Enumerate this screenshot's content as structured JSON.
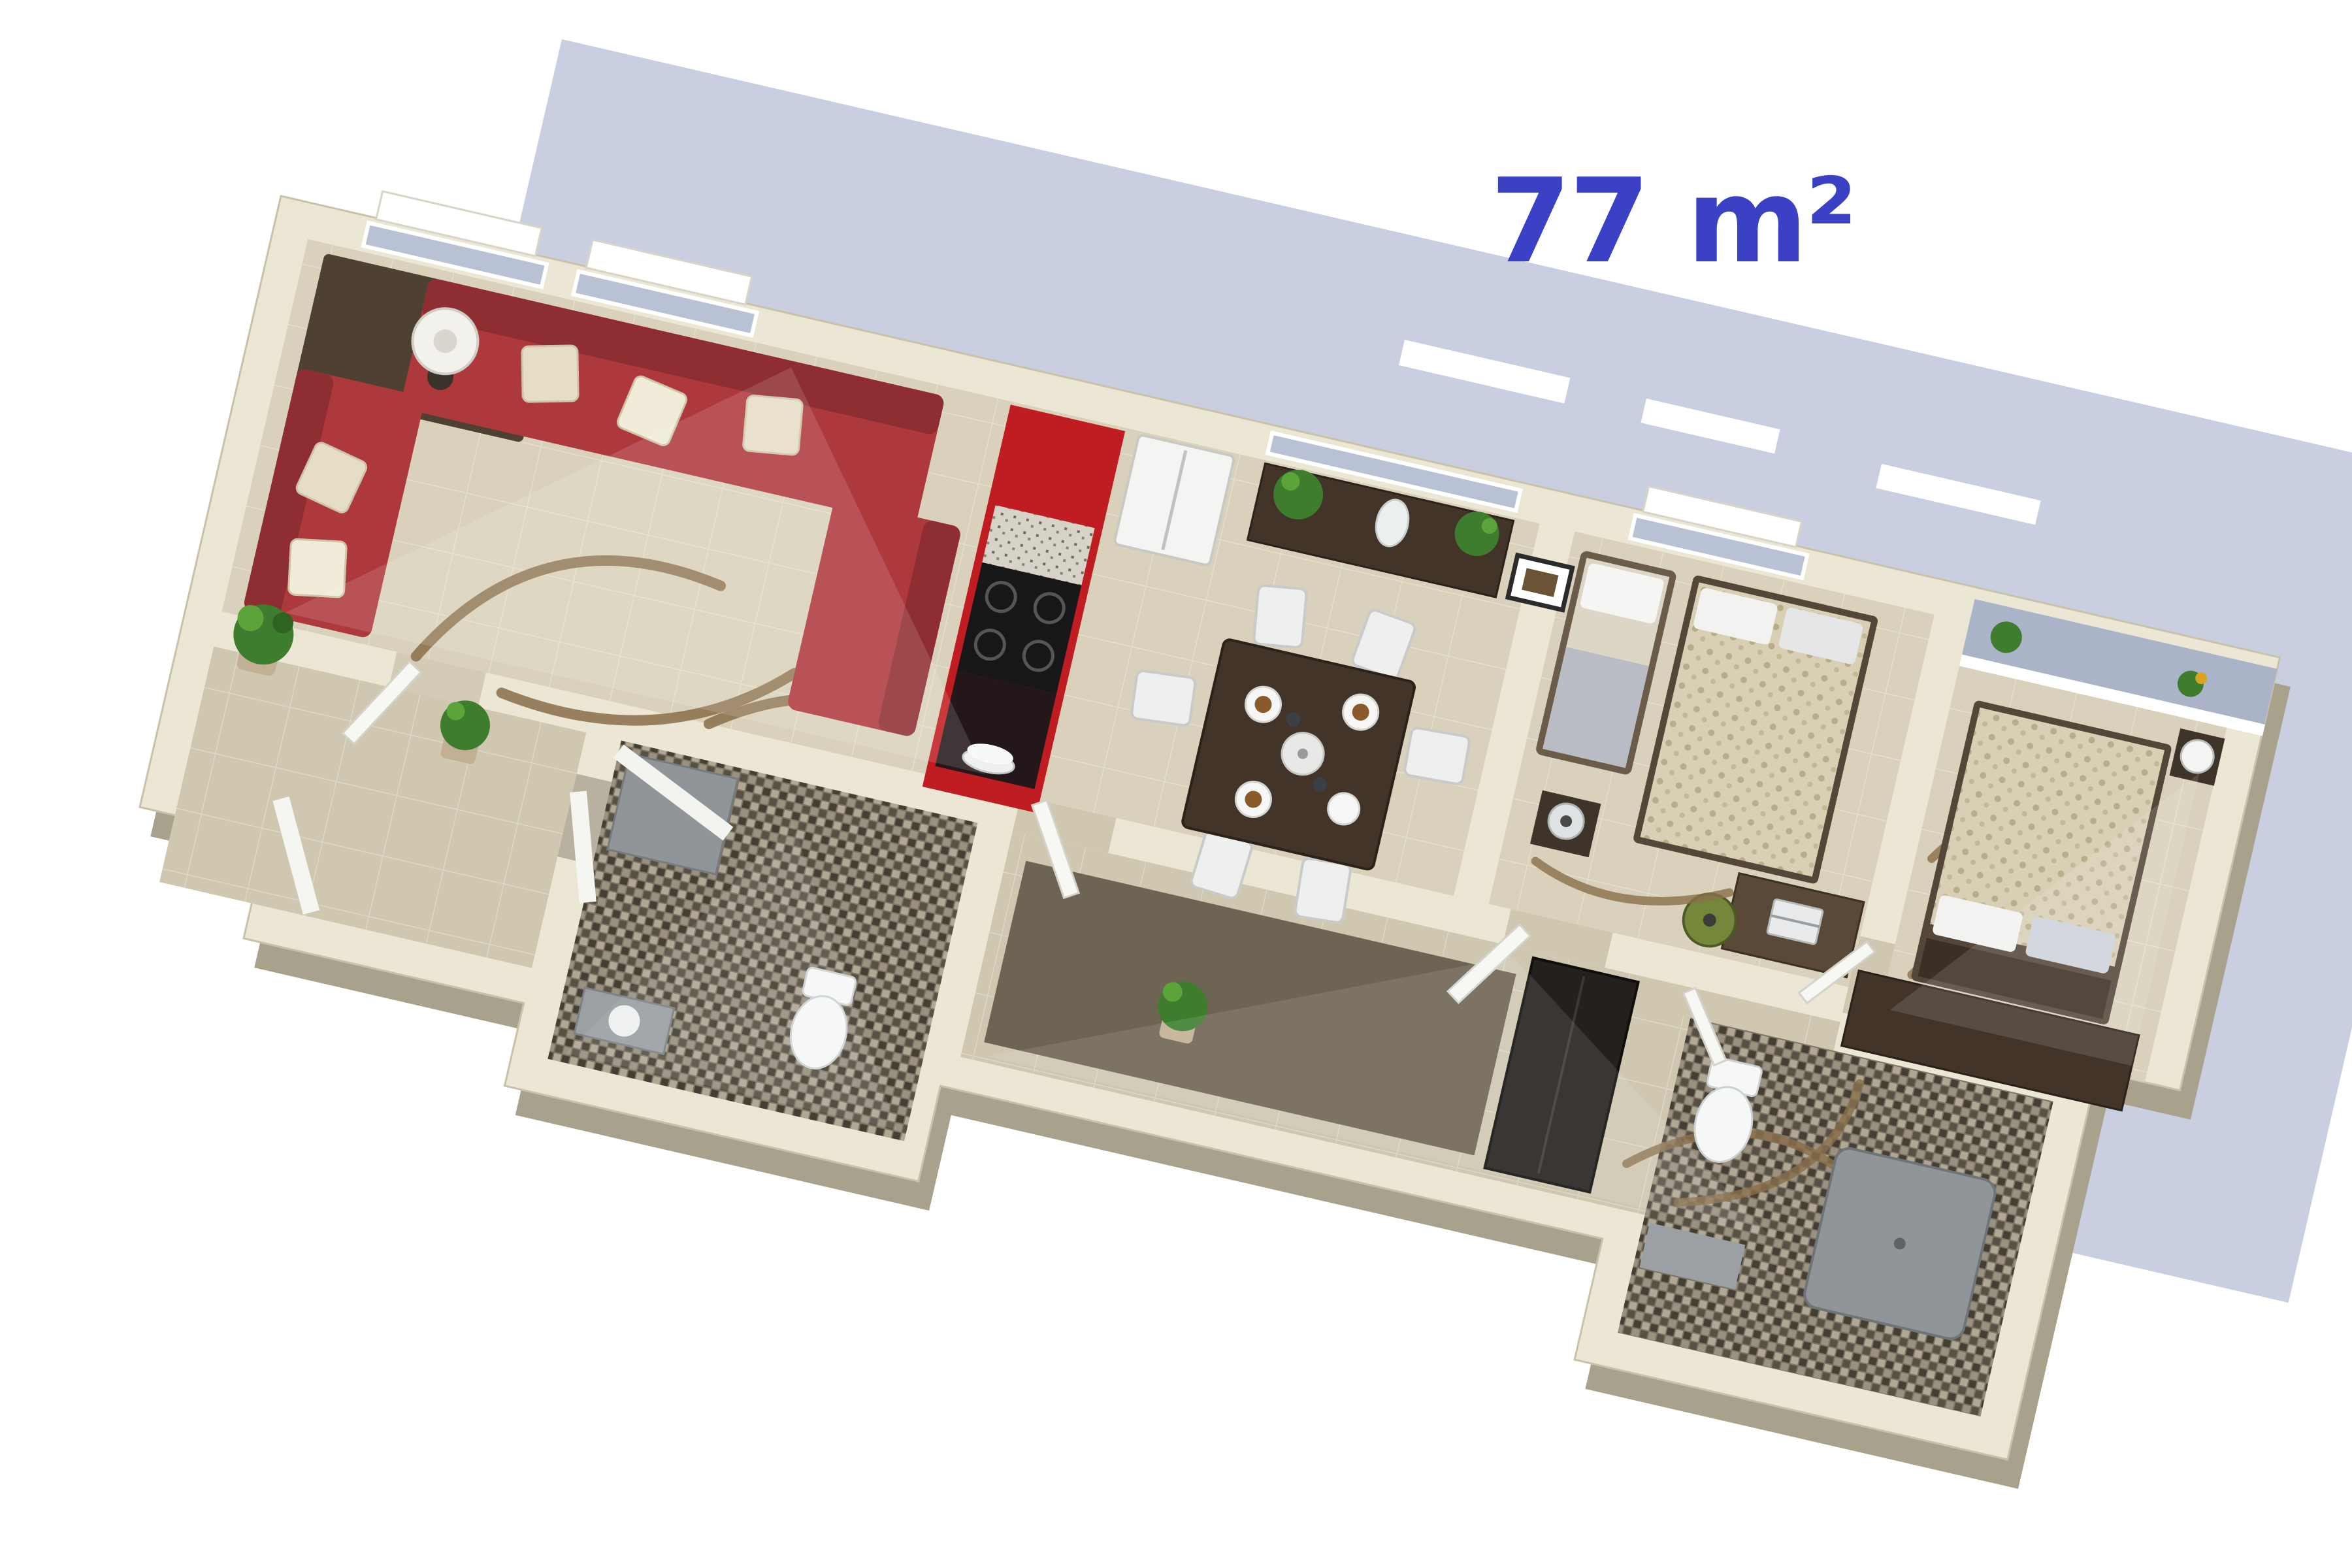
{
  "area_label": {
    "text": "77 m²",
    "color": "#3a41c5"
  },
  "palette": {
    "background": "#ffffff",
    "shadow": "#c9cfe1",
    "wall_top": "#ece7d4",
    "wall_side": "#a8a18c",
    "floor_main": "#d9d1bb",
    "floor_corridor": "#cfc7b0",
    "floor_dark": "#6e6454",
    "balcony_grey": "#aab3c7",
    "glass_grey": "#b9c2d4",
    "sofa_red": "#ae393d",
    "sofa_red_dark": "#8f2e32",
    "kitchen_red": "#c01d22",
    "cooktop_black": "#17171a",
    "wood_dark": "#423428",
    "chair_white": "#eef0ef",
    "duvet_beige": "#d8cfb4",
    "mosaic_brown": "#7d7466",
    "rug_swirl_brown": "#8a6f4a",
    "plant_green": "#3e7d2d",
    "office_chair_green": "#74873a",
    "fixture_white": "#f6f7f7",
    "shower_grey": "#8f9598"
  },
  "scene": {
    "description": "3D isometric render of a 77 m2 apartment floor plan on white background with blue-grey cast shadow",
    "rotation_deg": 13,
    "rooms": [
      {
        "name": "living-room",
        "furniture": [
          "corner-sofa-red",
          "floor-lamp",
          "dark-rug",
          "swirl-rug",
          "corner-plant"
        ]
      },
      {
        "name": "kitchen",
        "furniture": [
          "red-cabinet-bar",
          "cooktop",
          "counter",
          "fridge",
          "plate-stack"
        ]
      },
      {
        "name": "dining-area",
        "furniture": [
          "dining-table",
          "six-white-chairs",
          "plates-with-food",
          "teapot",
          "sideboard",
          "plants",
          "white-vase",
          "wall-picture"
        ]
      },
      {
        "name": "bedroom-1",
        "furniture": [
          "double-bed",
          "single-bed",
          "nightstand-cone-lamp",
          "desk",
          "laptop",
          "office-chair"
        ]
      },
      {
        "name": "bedroom-2",
        "furniture": [
          "double-bed",
          "nightstand-ball-lamp",
          "low-dresser",
          "swirl-rug"
        ]
      },
      {
        "name": "hallway",
        "furniture": [
          "dark-wardrobe",
          "plant",
          "dark-floor-strip"
        ]
      },
      {
        "name": "bathroom-1",
        "furniture": [
          "toilet",
          "sink",
          "shower-glass",
          "mosaic-floor"
        ]
      },
      {
        "name": "bathroom-2",
        "furniture": [
          "toilet",
          "shower-tray",
          "mosaic-floor"
        ]
      },
      {
        "name": "entry-hall",
        "furniture": [
          "front-door",
          "potted-plant"
        ]
      },
      {
        "name": "balcony",
        "furniture": [
          "plants",
          "parapet"
        ]
      }
    ]
  }
}
